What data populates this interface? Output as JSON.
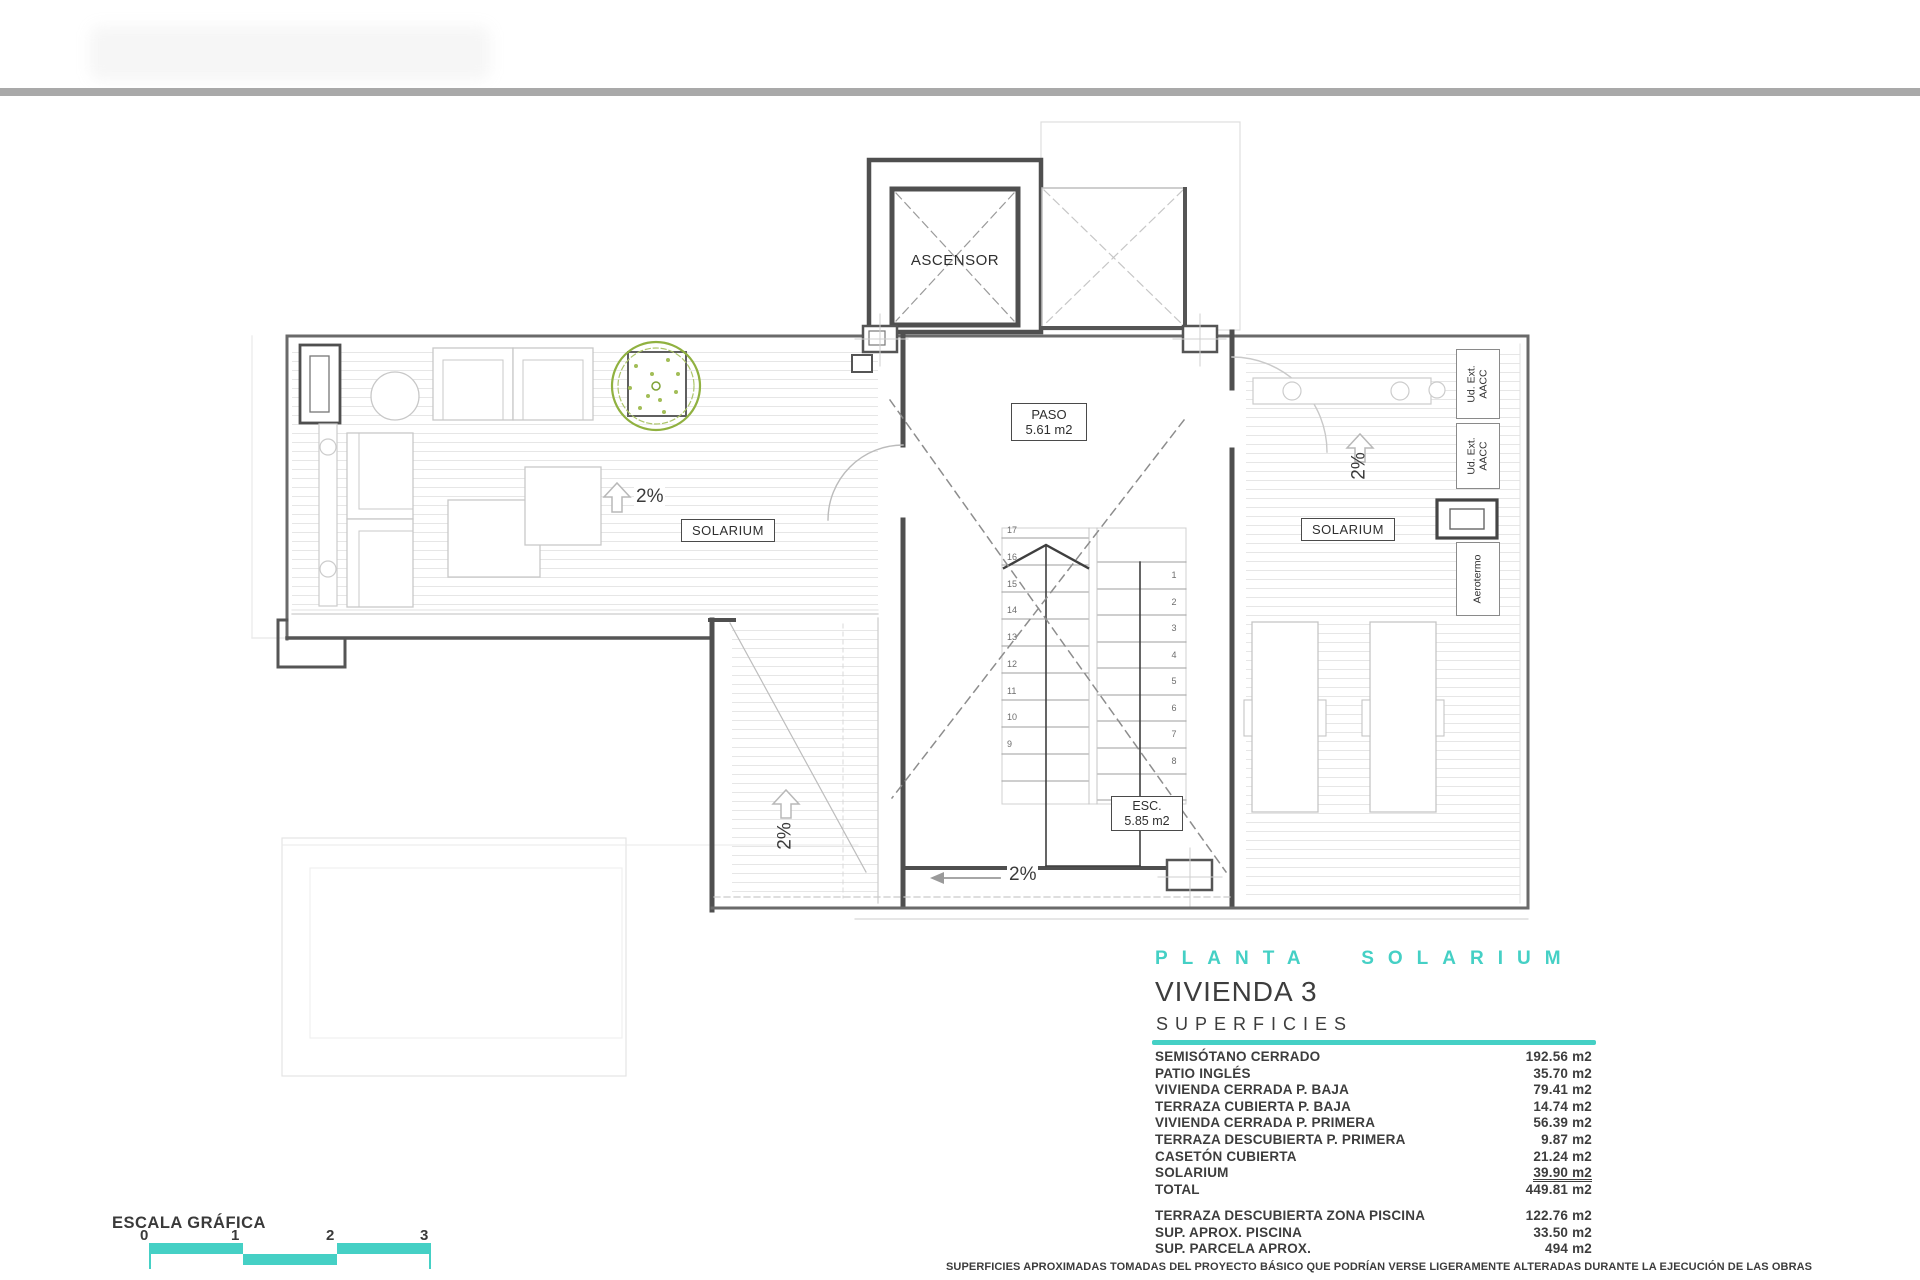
{
  "colors": {
    "accent_teal": "#45d0c5",
    "tree_green": "#90b140",
    "wall_dark": "#4f4f4f",
    "top_bar_gray": "#a9a9a9"
  },
  "plan": {
    "labels": {
      "ascensor": "ASCENSOR",
      "paso_title": "PASO",
      "paso_area": "5.61 m2",
      "esc_title": "ESC.",
      "esc_area": "5.85 m2",
      "solarium_left": "SOLARIUM",
      "solarium_right": "SOLARIUM",
      "aerotermo": "Aerotermo",
      "ud_ext_line1": "Ud. Ext.",
      "ud_ext_line2": "AACC"
    },
    "slopes": {
      "left": "2%",
      "right": "2%",
      "strip": "2%",
      "bottom": "2%"
    },
    "stairs": {
      "left_numbers": [
        "17",
        "16",
        "15",
        "14",
        "13",
        "12",
        "11",
        "10",
        "9"
      ],
      "right_numbers": [
        "1",
        "2",
        "3",
        "4",
        "5",
        "6",
        "7",
        "8"
      ]
    }
  },
  "title_block": {
    "plan_name": "PLANTA SOLARIUM",
    "unit_name": "VIVIENDA 3",
    "section_title": "SUPERFICIES",
    "areas": [
      {
        "label": "SEMISÓTANO CERRADO",
        "value": "192.56 m2"
      },
      {
        "label": "PATIO INGLÉS",
        "value": "35.70 m2"
      },
      {
        "label": "VIVIENDA CERRADA P. BAJA",
        "value": "79.41 m2"
      },
      {
        "label": "TERRAZA CUBIERTA P. BAJA",
        "value": "14.74 m2"
      },
      {
        "label": "VIVIENDA CERRADA P. PRIMERA",
        "value": "56.39 m2"
      },
      {
        "label": "TERRAZA DESCUBIERTA P. PRIMERA",
        "value": "9.87 m2"
      },
      {
        "label": "CASETÓN CUBIERTA",
        "value": "21.24 m2"
      },
      {
        "label": "SOLARIUM",
        "value": "39.90 m2"
      },
      {
        "label": "TOTAL",
        "value": "449.81 m2"
      }
    ],
    "extra_areas": [
      {
        "label": "TERRAZA DESCUBIERTA  ZONA PISCINA",
        "value": "122.76 m2"
      },
      {
        "label": "SUP.  APROX.  PISCINA",
        "value": "33.50 m2"
      },
      {
        "label": "SUP. PARCELA APROX.",
        "value": "494 m2"
      }
    ]
  },
  "scale_bar": {
    "title": "ESCALA GRÁFICA",
    "ticks": [
      "0",
      "1",
      "2",
      "3"
    ]
  },
  "footnote": "SUPERFICIES APROXIMADAS TOMADAS DEL PROYECTO BÁSICO QUE PODRÍAN VERSE LIGERAMENTE ALTERADAS DURANTE LA EJECUCIÓN DE LAS OBRAS"
}
